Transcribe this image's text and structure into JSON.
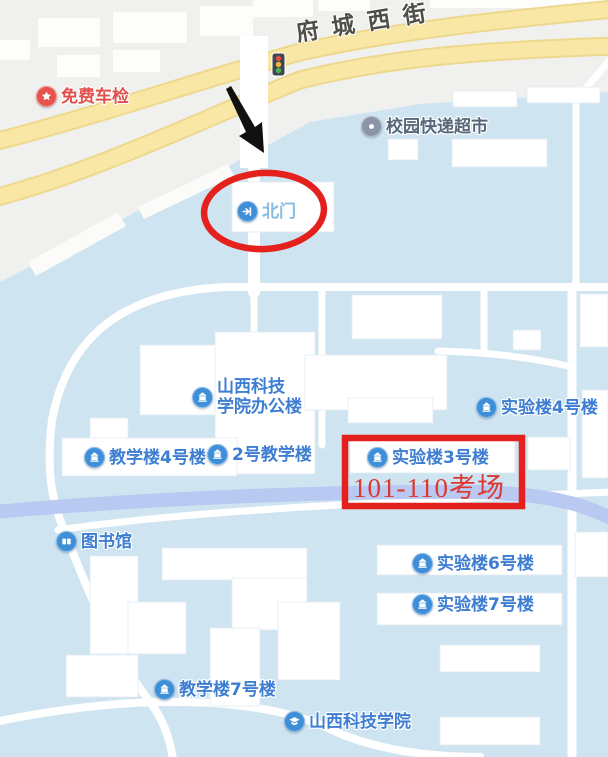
{
  "street": {
    "name": "府城西街"
  },
  "pois": [
    {
      "label": "免费车检",
      "icon": "star-badge",
      "text_color": "#e0514e"
    },
    {
      "label": "校园快递超市",
      "icon": "poi-dot",
      "text_color": "#57677a"
    },
    {
      "label": "北门",
      "icon": "gate-enter",
      "text_color": "#86bce2"
    },
    {
      "label": "山西科技\n学院办公楼",
      "icon": "building",
      "text_color": "#3e7ed2"
    },
    {
      "label": "教学楼4号楼",
      "icon": "building",
      "text_color": "#3e7ed2"
    },
    {
      "label": "2号教学楼",
      "icon": "building",
      "text_color": "#3e7ed2"
    },
    {
      "label": "实验楼4号楼",
      "icon": "building",
      "text_color": "#3e7ed2"
    },
    {
      "label": "实验楼3号楼",
      "icon": "building",
      "text_color": "#3e7ed2"
    },
    {
      "label": "图书馆",
      "icon": "book",
      "text_color": "#3e7ed2"
    },
    {
      "label": "实验楼6号楼",
      "icon": "building",
      "text_color": "#3e7ed2"
    },
    {
      "label": "实验楼7号楼",
      "icon": "building",
      "text_color": "#3e7ed2"
    },
    {
      "label": "教学楼7号楼",
      "icon": "building",
      "text_color": "#3e7ed2"
    },
    {
      "label": "山西科技学院",
      "icon": "graduation-cap",
      "text_color": "#3e7ed2"
    }
  ],
  "annotations": {
    "exam_text": "101-110考场",
    "highlight_color": "#e4211c",
    "arrow_color": "#111111"
  },
  "colors": {
    "campus_area": "#cfe4f1",
    "road_yellow": "#f9e7a6",
    "road_casing": "#eed88e",
    "river": "#bac9f2",
    "building_fill": "#ffffff",
    "poi_blue": "#3f8fd8",
    "label_blue": "#3e7ed2"
  }
}
